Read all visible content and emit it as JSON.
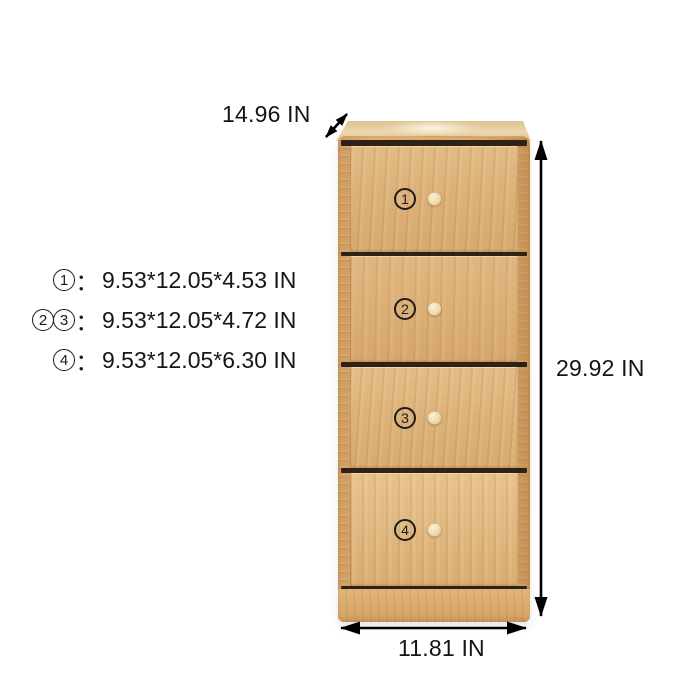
{
  "background": "#ffffff",
  "dimensions": {
    "depth_label": "14.96 IN",
    "height_label": "29.92 IN",
    "width_label": "11.81 IN"
  },
  "spec": {
    "colon": "：",
    "lines": [
      {
        "badges": [
          "1"
        ],
        "value": "9.53*12.05*4.53 IN"
      },
      {
        "badges": [
          "2",
          "3"
        ],
        "value": "9.53*12.05*4.72 IN"
      },
      {
        "badges": [
          "4"
        ],
        "value": "9.53*12.05*6.30 IN"
      }
    ]
  },
  "cabinet": {
    "drawers": [
      {
        "number": "1"
      },
      {
        "number": "2"
      },
      {
        "number": "3"
      },
      {
        "number": "4"
      }
    ],
    "colors": {
      "wood_light": "#ecd7ae",
      "wood_mid": "#ddb078",
      "wood_frame": "#d2a066",
      "drawer_gap": "#2e2115",
      "knob": "#f2e7c6"
    }
  },
  "annotation": {
    "text_color": "#141414",
    "arrow_color": "#000000"
  }
}
